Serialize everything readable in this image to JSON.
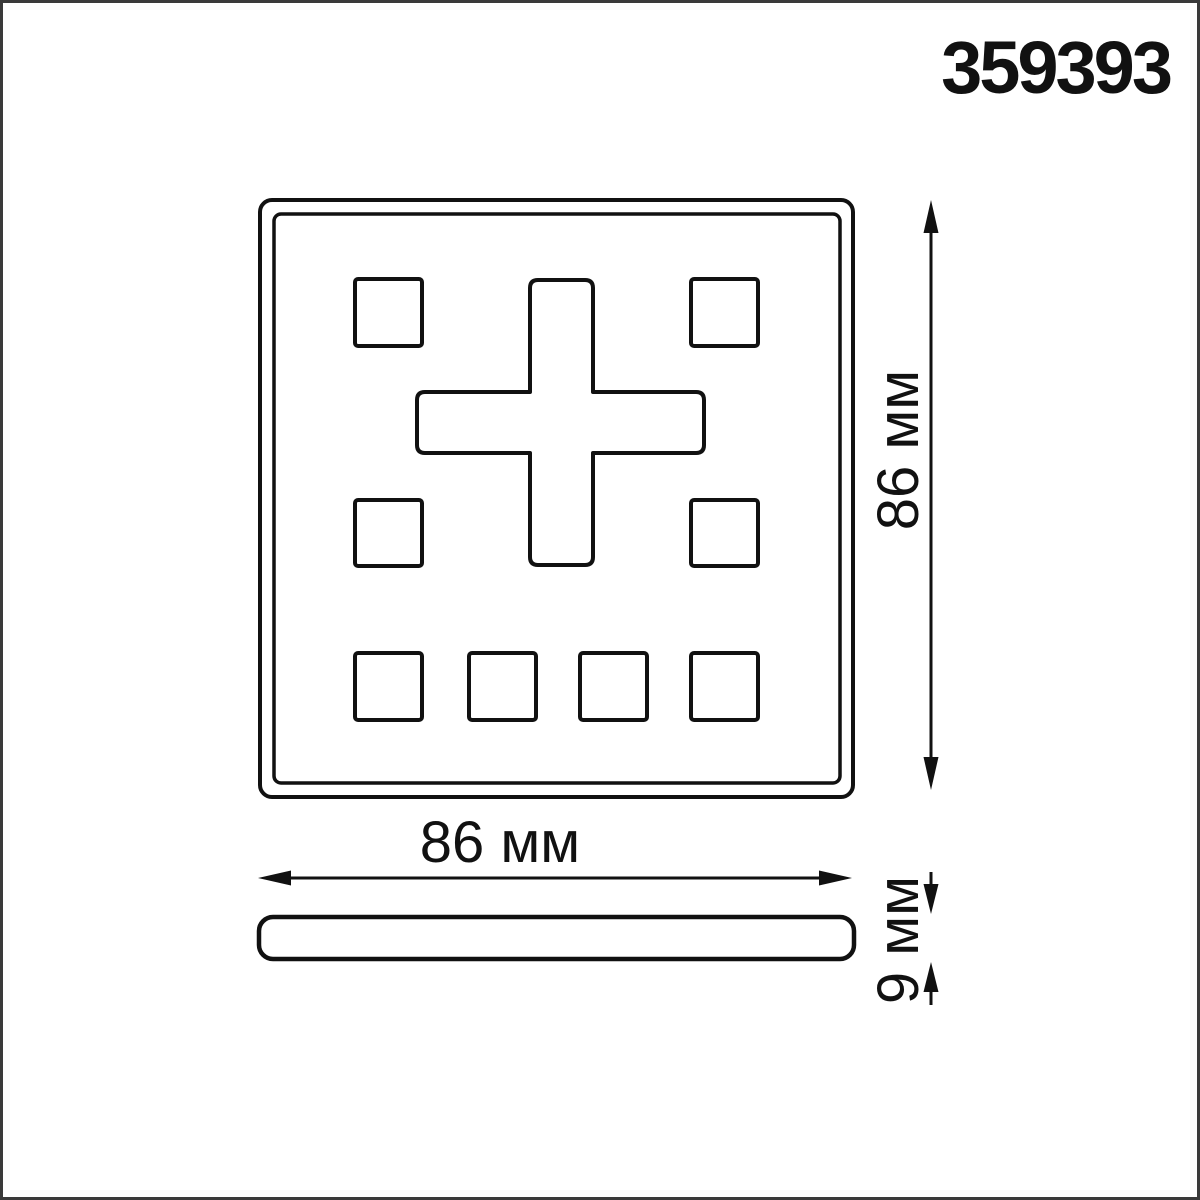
{
  "part_number": "359393",
  "front_view": {
    "height_label": "86 мм",
    "width_label": "86 мм"
  },
  "side_view": {
    "thickness_label": "9 мм"
  },
  "colors": {
    "line": "#111111",
    "frame": "#3a3a3a",
    "background": "#ffffff"
  }
}
